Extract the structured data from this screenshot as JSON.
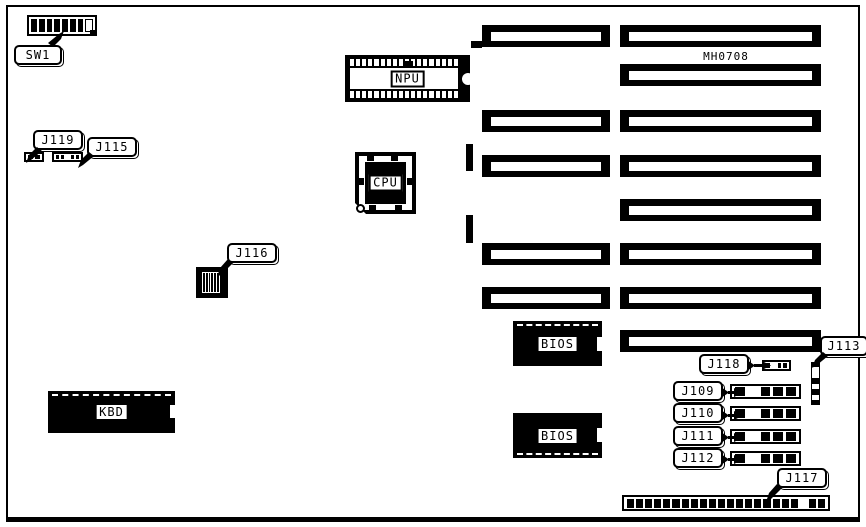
{
  "board": {
    "part_number": "MH0708"
  },
  "components": {
    "sw1": {
      "label": "SW1",
      "switches": [
        "on",
        "on",
        "on",
        "on",
        "on",
        "on",
        "on",
        "off"
      ]
    },
    "npu": {
      "label": "NPU",
      "pins_per_row": 18
    },
    "cpu": {
      "label": "CPU"
    },
    "kbd": {
      "label": "KBD"
    },
    "bios1": {
      "label": "BIOS"
    },
    "bios2": {
      "label": "BIOS"
    },
    "j119": {
      "label": "J119",
      "pins": [
        "on",
        "on"
      ]
    },
    "j115": {
      "label": "J115",
      "pins": [
        "on",
        "on",
        "off",
        "on",
        "on"
      ]
    },
    "j116": {
      "label": "J116",
      "stripes": 6
    },
    "j113": {
      "label": "J113",
      "segments": [
        "on",
        "off",
        "on",
        "off",
        "on",
        "off",
        "on"
      ]
    },
    "j118": {
      "label": "J118",
      "pins": [
        "on",
        "off",
        "on",
        "on"
      ]
    },
    "j109": {
      "label": "J109",
      "pins": [
        "on",
        "off",
        "on",
        "on",
        "on"
      ]
    },
    "j110": {
      "label": "J110",
      "pins": [
        "on",
        "off",
        "on",
        "on",
        "on"
      ]
    },
    "j111": {
      "label": "J111",
      "pins": [
        "on",
        "off",
        "on",
        "on",
        "on"
      ]
    },
    "j112": {
      "label": "J112",
      "pins": [
        "on",
        "off",
        "on",
        "on",
        "on"
      ]
    },
    "j117": {
      "label": "J117",
      "pins": [
        "on",
        "on",
        "on",
        "on",
        "on",
        "on",
        "on",
        "on",
        "on",
        "on",
        "on",
        "on",
        "on",
        "on",
        "on",
        "on",
        "on",
        "on",
        "on",
        "off",
        "on",
        "on"
      ]
    }
  },
  "slots": {
    "left_column": {
      "x": 482,
      "width": 128,
      "height": 22,
      "rows_y": [
        25,
        110,
        155,
        243,
        287
      ]
    },
    "right_column": {
      "x": 620,
      "width": 201,
      "height": 22,
      "rows_y": [
        25,
        64,
        110,
        155,
        199,
        243,
        287,
        330
      ]
    }
  }
}
